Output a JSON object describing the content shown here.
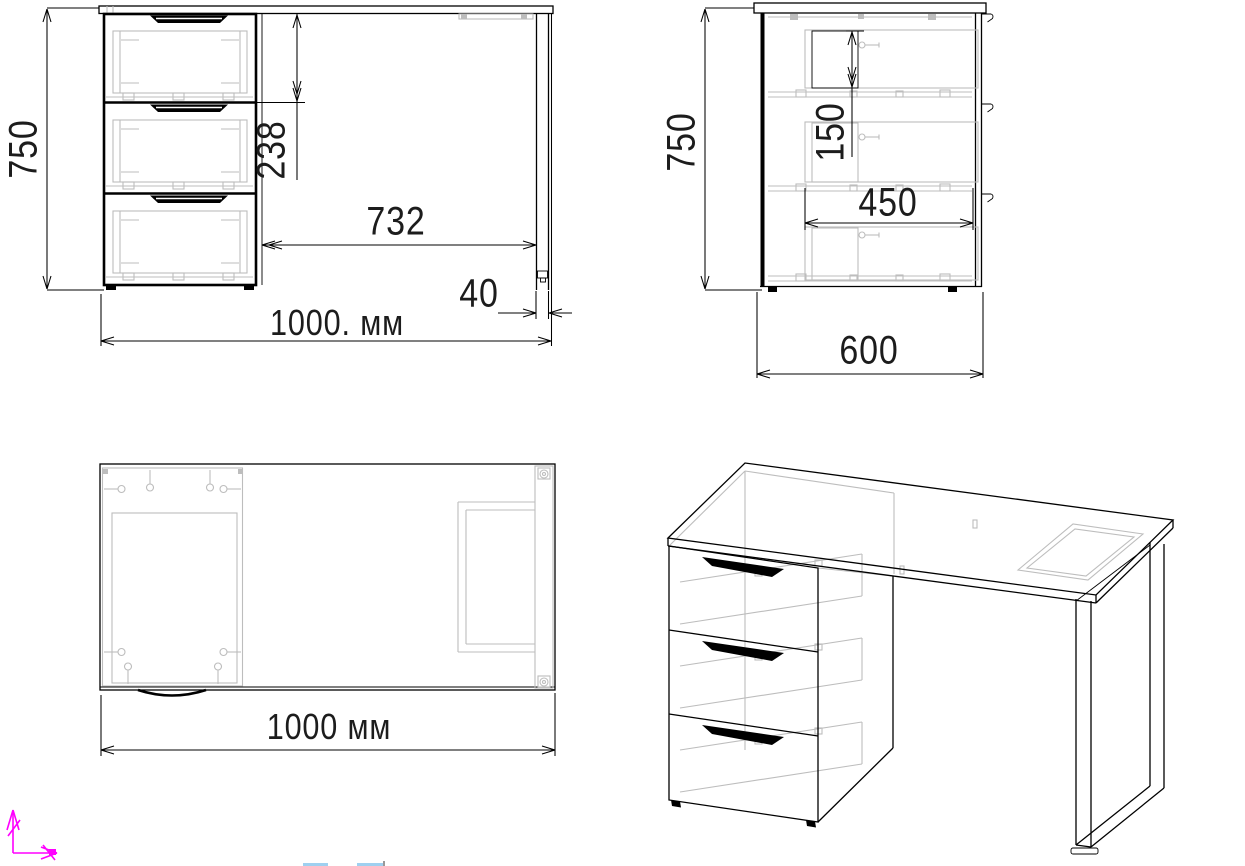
{
  "drawing": {
    "front_view": {
      "height_mm": "750",
      "drawer_pitch_mm": "238",
      "knee_span_mm": "732",
      "leg_width_mm": "40",
      "total_width": "1000. мм"
    },
    "side_view": {
      "height_mm": "750",
      "drawer_inner_mm": "150",
      "slide_length_mm": "450",
      "depth_mm": "600"
    },
    "top_view": {
      "total_width": "1000 мм"
    }
  },
  "colors": {
    "background": "#ffffff",
    "line": "#000000",
    "hidden": "#bdbdbd",
    "dim_text": "#1c1c1c",
    "ucs_axis": "#ff00ff",
    "fragment_blue": "#9fd0f0",
    "fragment_gray": "#999999"
  },
  "icons": {
    "ucs_axis": "magenta X/Y coordinate-system arrows"
  }
}
